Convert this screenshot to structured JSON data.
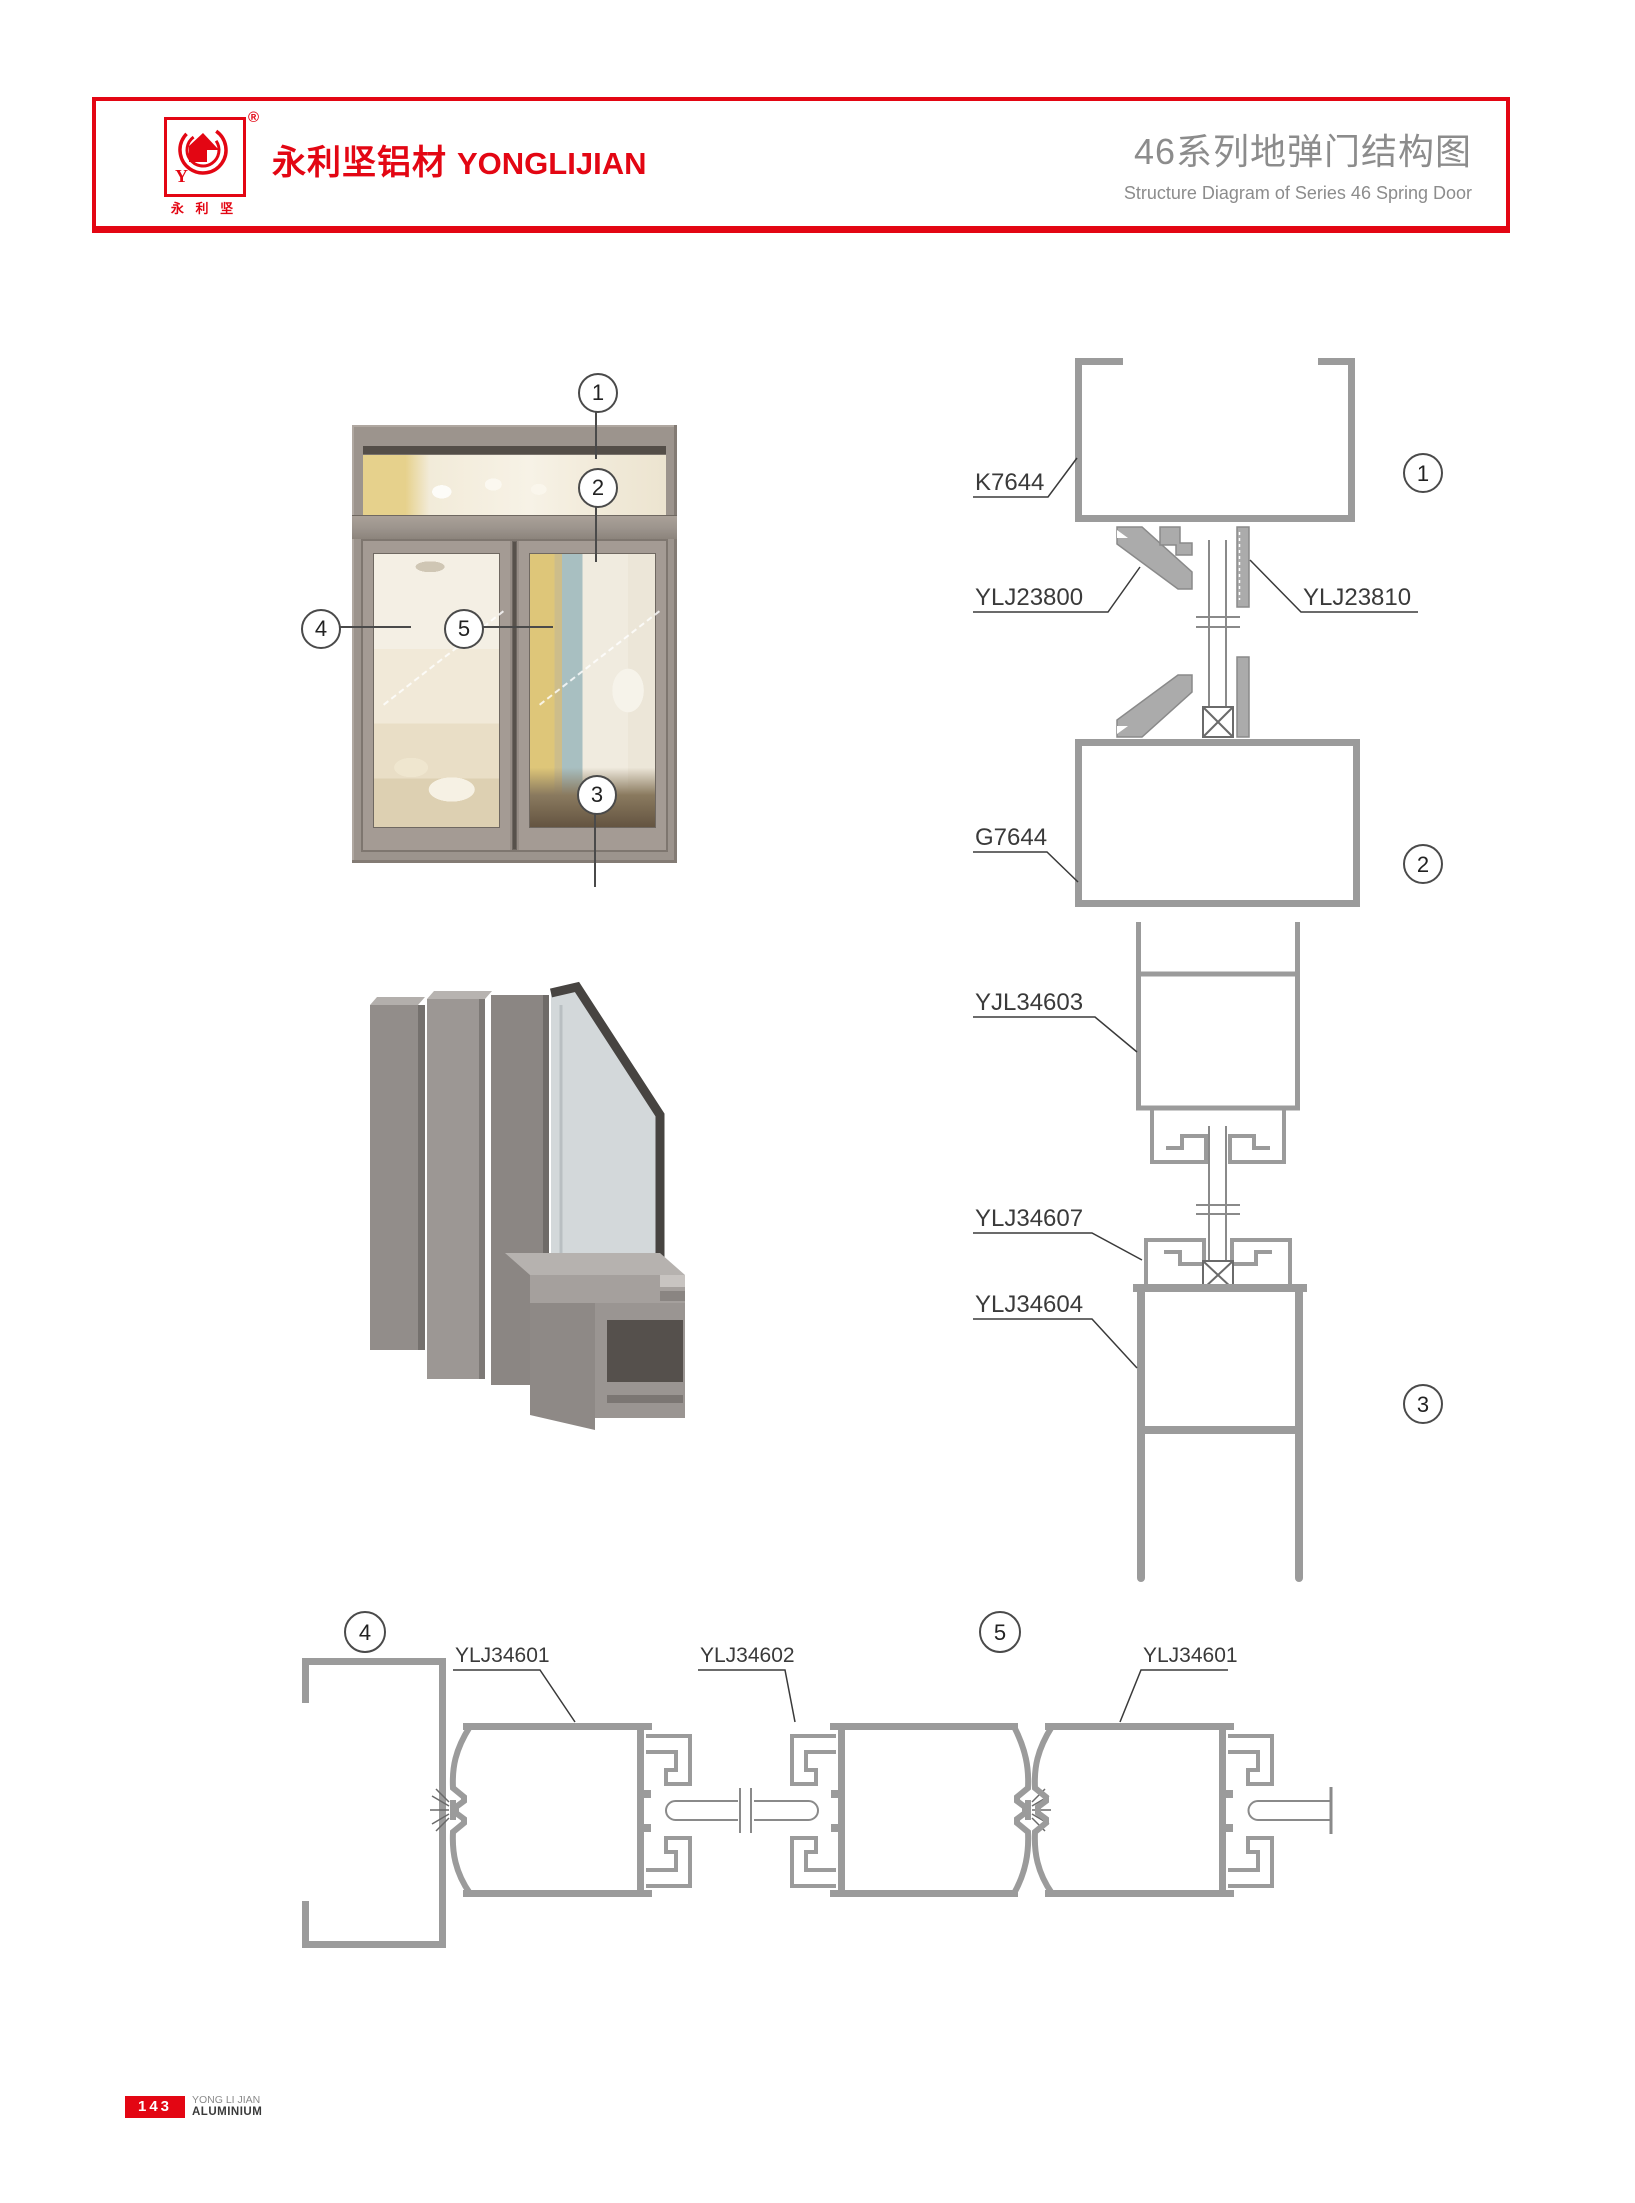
{
  "header": {
    "logo": {
      "registered": "®",
      "caption": "永 利 坚",
      "monogram": "Y"
    },
    "brand_cn": "永利坚铝材",
    "brand_en": "YONGLIJIAN",
    "title_cn": "46系列地弹门结构图",
    "title_en": "Structure Diagram of Series 46 Spring Door"
  },
  "callouts": {
    "n1": "1",
    "n2": "2",
    "n3": "3",
    "n4": "4",
    "n5": "5"
  },
  "part_labels": {
    "top_frame": "K7644",
    "transom_bead_left": "YLJ23800",
    "transom_bead_right": "YLJ23810",
    "transom_bottom_frame": "G7644",
    "door_top_rail": "YJL34603",
    "glazing_bead": "YLJ34607",
    "door_bottom_rail": "YLJ34604",
    "left_stile": "YLJ34601",
    "meeting_stile": "YLJ34602",
    "right_stile": "YLJ34601"
  },
  "footer": {
    "page_number": "143",
    "company_en": "YONG LI JIAN",
    "division": "ALUMINIUM"
  },
  "colors": {
    "brand_red": "#e30613",
    "heading_gray": "#8c8c8c",
    "drawing_gray": "#9b9b9b",
    "label_ink": "#3a3a3a",
    "door_frame_taupe": "#9c948d"
  }
}
